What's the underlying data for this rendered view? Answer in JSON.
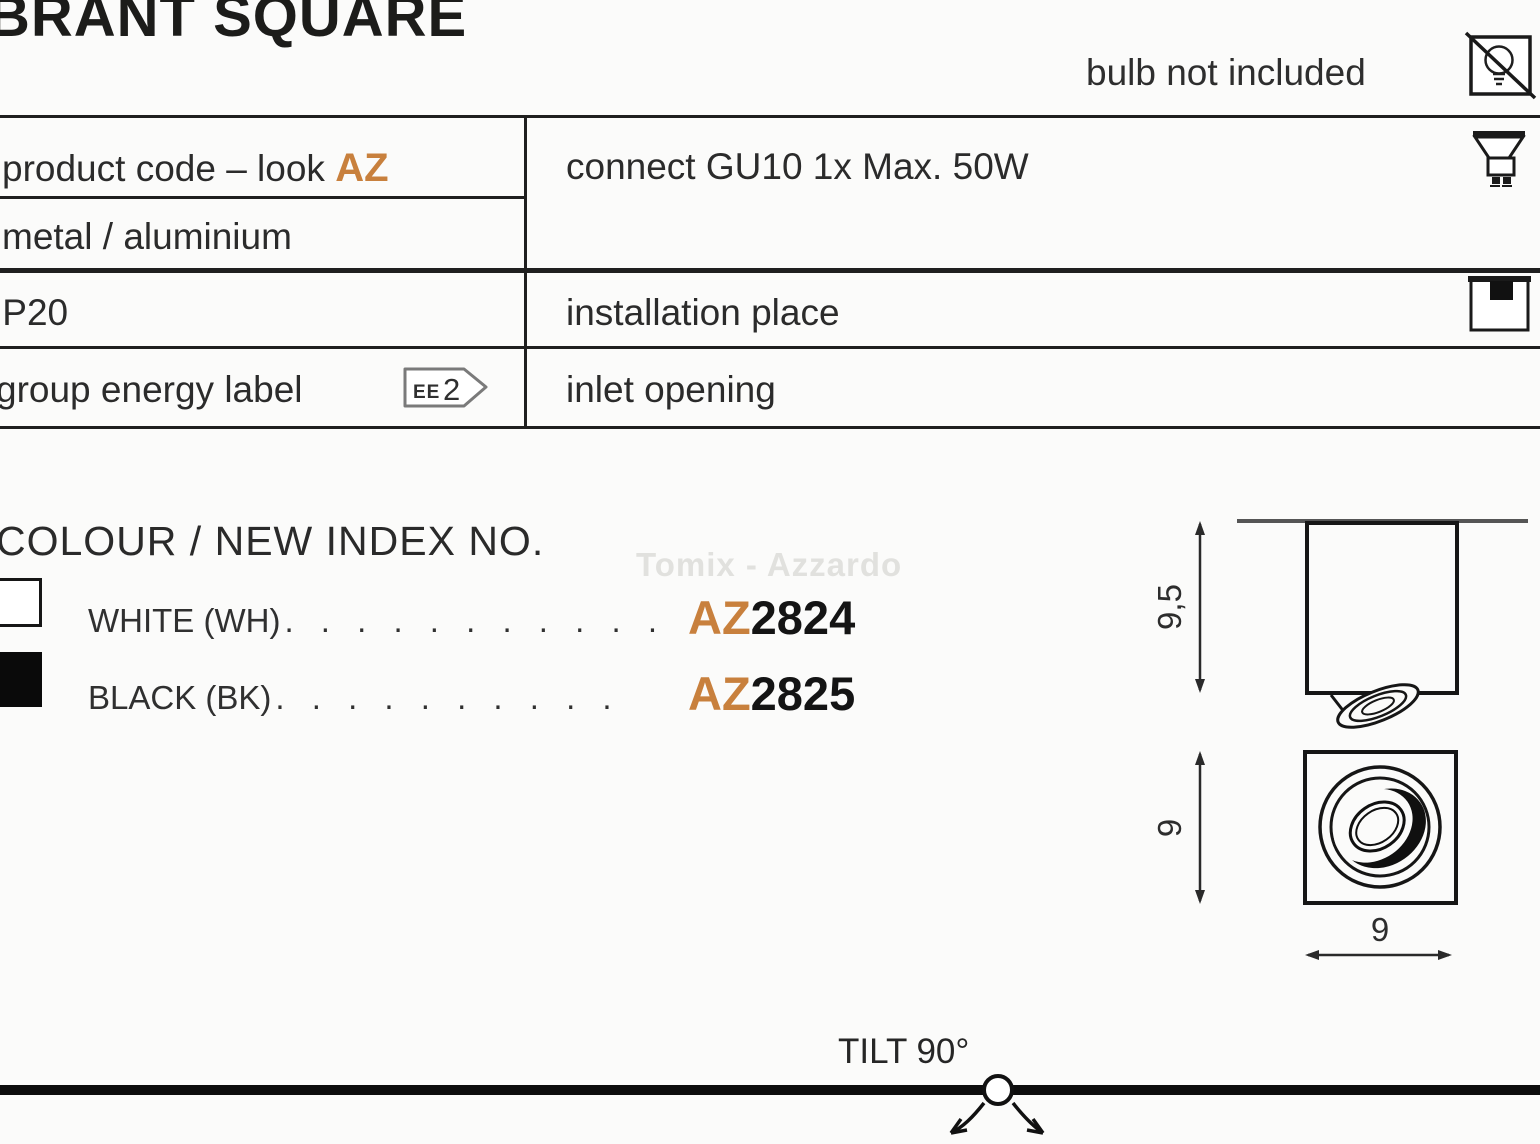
{
  "title": "BRANT SQUARE",
  "header": {
    "bulb_note": "bulb not included"
  },
  "spec_table": {
    "product_code_label": "product code – look",
    "product_code_accent": "AZ",
    "material": "metal / aluminium",
    "ip_rating": "IP20",
    "energy_label_text": "group energy label",
    "energy_badge_prefix": "EE",
    "energy_badge_value": "2",
    "connect": "connect GU10 1x Max. 50W",
    "installation_place": "installation place",
    "inlet_opening": "inlet opening"
  },
  "colour_section": {
    "heading": "COLOUR / NEW INDEX NO.",
    "watermark": "Tomix - Azzardo",
    "options": [
      {
        "colour": "white",
        "label": "WHITE (WH)",
        "leader_dots": ". . . . . . . . . . .",
        "code_prefix": "AZ",
        "code_number": "2824"
      },
      {
        "colour": "black",
        "label": "BLACK (BK)",
        "leader_dots": ". . . . . . . . . .",
        "code_prefix": "AZ",
        "code_number": "2825"
      }
    ]
  },
  "dimension_drawings": {
    "side_view_height": "9,5",
    "bottom_view_height": "9",
    "bottom_view_width": "9"
  },
  "tilt_label": "TILT 90°",
  "colors": {
    "accent_orange": "#c8803d",
    "text_black": "#2b2b2b",
    "watermark_gray": "#e1e1de",
    "ceiling_gray": "#555555"
  }
}
